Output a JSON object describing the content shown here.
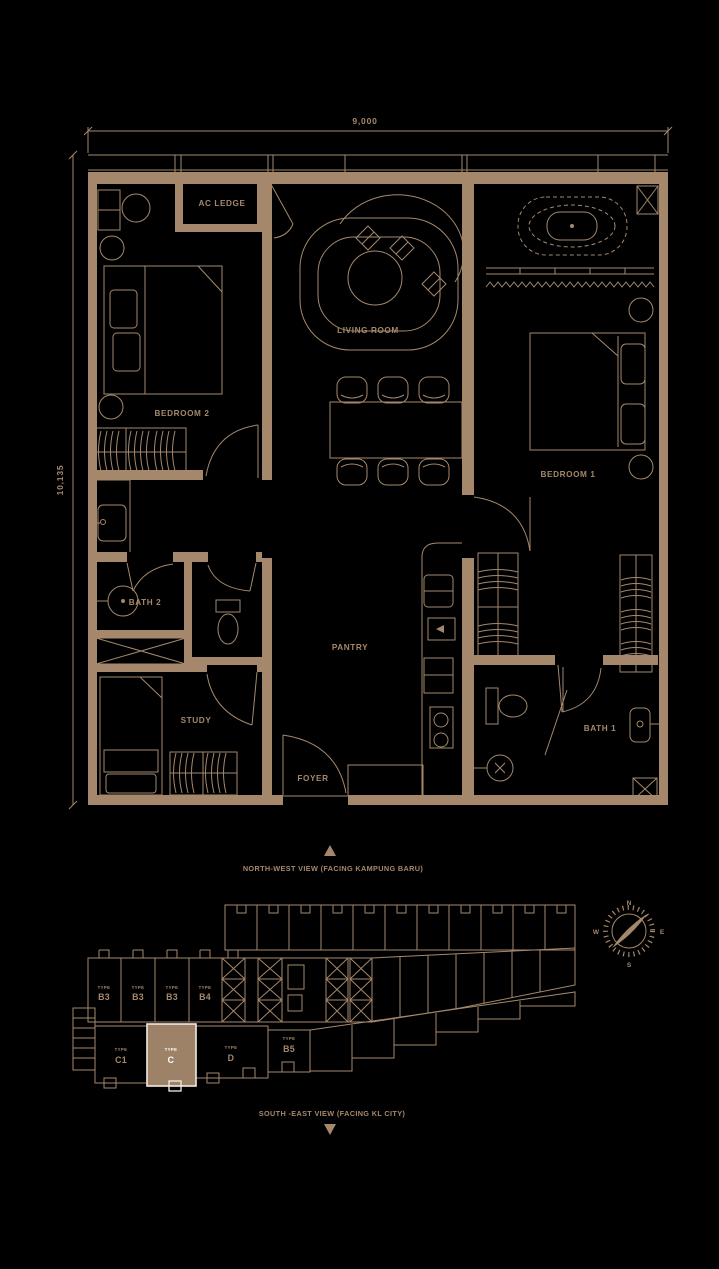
{
  "colors": {
    "background": "#000000",
    "line": "#a5886c",
    "highlight_fill": "#9d8268",
    "highlight_stroke": "#f2ece4",
    "highlight_text": "#ffffff"
  },
  "dimensions": {
    "top": "9,000",
    "left": "10,135"
  },
  "rooms": [
    {
      "label": "AC LEDGE"
    },
    {
      "label": "LIVING ROOM"
    },
    {
      "label": "BEDROOM 2"
    },
    {
      "label": "BEDROOM 1"
    },
    {
      "label": "BATH 2"
    },
    {
      "label": "PANTRY"
    },
    {
      "label": "STUDY"
    },
    {
      "label": "FOYER"
    },
    {
      "label": "BATH 1"
    }
  ],
  "views": {
    "north": "NORTH-WEST VIEW (FACING KAMPUNG BARU)",
    "south": "SOUTH -EAST VIEW (FACING KL CITY)"
  },
  "compass": {
    "n": "N",
    "e": "E",
    "s": "S",
    "w": "W"
  },
  "keyplan": {
    "upper_units": [
      {
        "prefix": "TYPE",
        "label": "B3"
      },
      {
        "prefix": "TYPE",
        "label": "B3"
      },
      {
        "prefix": "TYPE",
        "label": "B3"
      },
      {
        "prefix": "TYPE",
        "label": "B4"
      }
    ],
    "lower_units": [
      {
        "prefix": "TYPE",
        "label": "C1"
      },
      {
        "prefix": "TYPE",
        "label": "C"
      },
      {
        "prefix": "TYPE",
        "label": "D"
      },
      {
        "prefix": "TYPE",
        "label": "B5"
      }
    ]
  }
}
